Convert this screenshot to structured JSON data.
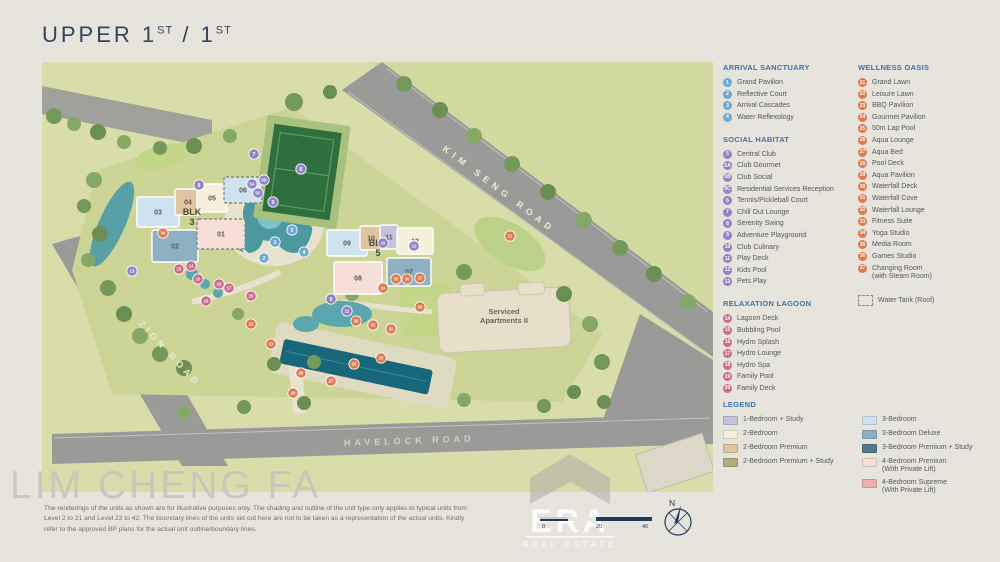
{
  "title": {
    "main": "UPPER 1",
    "sup_a": "ST",
    "divider": " / 1",
    "sup_b": "ST"
  },
  "map": {
    "roads": [
      {
        "name": "KIM SENG ROAD"
      },
      {
        "name": "ZION ROAD"
      },
      {
        "name": "HAVELOCK ROAD"
      }
    ],
    "serviced": {
      "line1": "Serviced",
      "line2": "Apartments II"
    },
    "blocks": [
      {
        "label_top": "BLK",
        "label_num": "3",
        "lx": 150,
        "ly": 153,
        "units": [
          {
            "no": "03",
            "x": 95,
            "y": 135,
            "w": 42,
            "h": 30,
            "type": "3br",
            "dashed": false
          },
          {
            "no": "04",
            "x": 133,
            "y": 127,
            "w": 26,
            "h": 26,
            "type": "2br_premium",
            "dashed": false
          },
          {
            "no": "05",
            "x": 155,
            "y": 122,
            "w": 30,
            "h": 28,
            "type": "2br",
            "dashed": false
          },
          {
            "no": "06",
            "x": 182,
            "y": 115,
            "w": 38,
            "h": 26,
            "type": "3br",
            "dashed": true
          },
          {
            "no": "02",
            "x": 110,
            "y": 168,
            "w": 46,
            "h": 32,
            "type": "3br_deluxe",
            "dashed": false
          },
          {
            "no": "01",
            "x": 155,
            "y": 157,
            "w": 48,
            "h": 30,
            "type": "4br_premium",
            "dashed": true
          }
        ]
      },
      {
        "label_top": "BLK",
        "label_num": "5",
        "lx": 336,
        "ly": 184,
        "units": [
          {
            "no": "09",
            "x": 285,
            "y": 168,
            "w": 40,
            "h": 26,
            "type": "3br",
            "dashed": false
          },
          {
            "no": "10",
            "x": 318,
            "y": 164,
            "w": 22,
            "h": 24,
            "type": "2br_premium",
            "dashed": false
          },
          {
            "no": "11",
            "x": 338,
            "y": 163,
            "w": 18,
            "h": 24,
            "type": "1br_study",
            "dashed": false
          },
          {
            "no": "12",
            "x": 355,
            "y": 166,
            "w": 36,
            "h": 26,
            "type": "2br",
            "dashed": false
          },
          {
            "no": "07",
            "x": 345,
            "y": 196,
            "w": 44,
            "h": 28,
            "type": "3br_deluxe",
            "dashed": false
          },
          {
            "no": "08",
            "x": 292,
            "y": 200,
            "w": 48,
            "h": 32,
            "type": "4br_premium",
            "dashed": false
          }
        ]
      }
    ],
    "markers": [
      {
        "n": "1",
        "cat": "arrival",
        "x": 233,
        "y": 180
      },
      {
        "n": "2",
        "cat": "arrival",
        "x": 222,
        "y": 196
      },
      {
        "n": "3",
        "cat": "arrival",
        "x": 250,
        "y": 168
      },
      {
        "n": "4",
        "cat": "arrival",
        "x": 262,
        "y": 190
      },
      {
        "n": "5",
        "cat": "social",
        "x": 231,
        "y": 140
      },
      {
        "n": "5A",
        "cat": "social",
        "x": 210,
        "y": 122
      },
      {
        "n": "5B",
        "cat": "social",
        "x": 222,
        "y": 118
      },
      {
        "n": "5C",
        "cat": "social",
        "x": 216,
        "y": 131
      },
      {
        "n": "6",
        "cat": "social",
        "x": 259,
        "y": 107
      },
      {
        "n": "7",
        "cat": "social",
        "x": 212,
        "y": 92
      },
      {
        "n": "8",
        "cat": "social",
        "x": 157,
        "y": 123
      },
      {
        "n": "9",
        "cat": "social",
        "x": 289,
        "y": 237
      },
      {
        "n": "10",
        "cat": "social",
        "x": 341,
        "y": 181
      },
      {
        "n": "11",
        "cat": "social",
        "x": 305,
        "y": 249
      },
      {
        "n": "12",
        "cat": "social",
        "x": 372,
        "y": 184
      },
      {
        "n": "13",
        "cat": "social",
        "x": 90,
        "y": 209
      },
      {
        "n": "14",
        "cat": "relaxation",
        "x": 149,
        "y": 204
      },
      {
        "n": "15",
        "cat": "relaxation",
        "x": 137,
        "y": 207
      },
      {
        "n": "16",
        "cat": "relaxation",
        "x": 156,
        "y": 217
      },
      {
        "n": "17",
        "cat": "relaxation",
        "x": 187,
        "y": 226
      },
      {
        "n": "18",
        "cat": "relaxation",
        "x": 177,
        "y": 222
      },
      {
        "n": "19",
        "cat": "relaxation",
        "x": 164,
        "y": 239
      },
      {
        "n": "20",
        "cat": "relaxation",
        "x": 209,
        "y": 234
      },
      {
        "n": "21",
        "cat": "wellness",
        "x": 468,
        "y": 174
      },
      {
        "n": "22",
        "cat": "wellness",
        "x": 209,
        "y": 262
      },
      {
        "n": "23",
        "cat": "wellness",
        "x": 229,
        "y": 282
      },
      {
        "n": "24",
        "cat": "wellness",
        "x": 341,
        "y": 226
      },
      {
        "n": "25",
        "cat": "wellness",
        "x": 312,
        "y": 302
      },
      {
        "n": "26",
        "cat": "wellness",
        "x": 259,
        "y": 311
      },
      {
        "n": "27",
        "cat": "wellness",
        "x": 289,
        "y": 319
      },
      {
        "n": "28",
        "cat": "wellness",
        "x": 339,
        "y": 296
      },
      {
        "n": "29",
        "cat": "wellness",
        "x": 251,
        "y": 331
      },
      {
        "n": "30",
        "cat": "wellness",
        "x": 314,
        "y": 259
      },
      {
        "n": "31",
        "cat": "wellness",
        "x": 331,
        "y": 263
      },
      {
        "n": "32",
        "cat": "wellness",
        "x": 349,
        "y": 267
      },
      {
        "n": "33",
        "cat": "wellness",
        "x": 378,
        "y": 245
      },
      {
        "n": "34",
        "cat": "wellness",
        "x": 121,
        "y": 171
      },
      {
        "n": "35",
        "cat": "wellness",
        "x": 354,
        "y": 217
      },
      {
        "n": "36",
        "cat": "wellness",
        "x": 365,
        "y": 217
      },
      {
        "n": "37",
        "cat": "wellness",
        "x": 378,
        "y": 216
      }
    ]
  },
  "panel": {
    "sections": [
      {
        "id": "arrival",
        "title": "ARRIVAL SANCTUARY",
        "items": [
          {
            "n": "1",
            "label": "Grand Pavilion"
          },
          {
            "n": "2",
            "label": "Reflective Court"
          },
          {
            "n": "3",
            "label": "Arrival Cascades"
          },
          {
            "n": "4",
            "label": "Water Reflexology"
          }
        ]
      },
      {
        "id": "social",
        "title": "SOCIAL HABITAT",
        "items": [
          {
            "n": "5",
            "label": "Central Club"
          },
          {
            "n": "5A",
            "label": "Club Gourmet"
          },
          {
            "n": "5B",
            "label": "Club Social"
          },
          {
            "n": "5C",
            "label": "Residential Services Reception"
          },
          {
            "n": "6",
            "label": "Tennis/Pickleball Court"
          },
          {
            "n": "7",
            "label": "Chill Out Lounge"
          },
          {
            "n": "8",
            "label": "Serenity Swing"
          },
          {
            "n": "9",
            "label": "Adventure Playground"
          },
          {
            "n": "10",
            "label": "Club Culinary"
          },
          {
            "n": "11",
            "label": "Play Deck"
          },
          {
            "n": "12",
            "label": "Kids Pool"
          },
          {
            "n": "13",
            "label": "Pets Play"
          }
        ]
      },
      {
        "id": "relaxation",
        "title": "RELAXATION LAGOON",
        "items": [
          {
            "n": "14",
            "label": "Lagoon Deck"
          },
          {
            "n": "15",
            "label": "Bubbling Pool"
          },
          {
            "n": "16",
            "label": "Hydro Splash"
          },
          {
            "n": "17",
            "label": "Hydro Lounge"
          },
          {
            "n": "18",
            "label": "Hydro Spa"
          },
          {
            "n": "19",
            "label": "Family Pool"
          },
          {
            "n": "20",
            "label": "Family Deck"
          }
        ]
      },
      {
        "id": "wellness",
        "title": "WELLNESS OASIS",
        "items": [
          {
            "n": "21",
            "label": "Grand Lawn"
          },
          {
            "n": "22",
            "label": "Leisure Lawn"
          },
          {
            "n": "23",
            "label": "BBQ Pavilion"
          },
          {
            "n": "24",
            "label": "Gourmet Pavilion"
          },
          {
            "n": "25",
            "label": "50m Lap Pool"
          },
          {
            "n": "26",
            "label": "Aqua Lounge"
          },
          {
            "n": "27",
            "label": "Aqua Bed"
          },
          {
            "n": "28",
            "label": "Pool Deck"
          },
          {
            "n": "29",
            "label": "Aqua Pavilion"
          },
          {
            "n": "30",
            "label": "Waterfall Deck"
          },
          {
            "n": "31",
            "label": "Waterfall Cove"
          },
          {
            "n": "32",
            "label": "Waterfall Lounge"
          },
          {
            "n": "33",
            "label": "Fitness Suite"
          },
          {
            "n": "34",
            "label": "Yoga Studio"
          },
          {
            "n": "35",
            "label": "Media Room"
          },
          {
            "n": "36",
            "label": "Games Studio"
          },
          {
            "n": "37",
            "label": "Changing Room",
            "label2": "(with Steam Room)"
          }
        ]
      }
    ],
    "water_tank_label": "Water Tank (Roof)",
    "legend": {
      "title": "LEGEND",
      "col1": [
        {
          "type": "1br_study",
          "label": "1-Bedroom + Study"
        },
        {
          "type": "2br",
          "label": "2-Bedroom"
        },
        {
          "type": "2br_premium",
          "label": "2-Bedroom Premium"
        },
        {
          "type": "2br_premium_study",
          "label": "2-Bedroom Premium + Study"
        }
      ],
      "col2": [
        {
          "type": "3br",
          "label": "3-Bedroom"
        },
        {
          "type": "3br_deluxe",
          "label": "3-Bedroom Deluxe"
        },
        {
          "type": "3br_premium_study",
          "label": "3-Bedroom Premium + Study"
        },
        {
          "type": "4br_premium",
          "label": "4-Bedroom Premium",
          "label2": "(With Private Lift)"
        },
        {
          "type": "4br_supreme",
          "label": "4-Bedroom Supreme",
          "label2": "(With Private Lift)"
        }
      ]
    }
  },
  "colors": {
    "categories": {
      "arrival": "#6fa9d2",
      "social": "#9184c5",
      "relaxation": "#cb6c8b",
      "wellness": "#dd7a50"
    },
    "unit_types": {
      "1br_study": "#c6c2db",
      "2br": "#f5efdc",
      "2br_premium": "#dfc6a0",
      "2br_premium_study": "#b0ad7f",
      "3br": "#cfe2f0",
      "3br_deluxe": "#8fb0c3",
      "3br_premium_study": "#55798a",
      "4br_premium": "#f6ded9",
      "4br_supreme": "#e9b3aa"
    },
    "accent": "#3f72a8",
    "ink": "#32455f"
  },
  "footer": {
    "disclaimer": "The renderings of the units as shown are for illustrative purposes only. The shading and outline of the unit type only applies to typical units from Level 2 to 21 and Level 23 to 42. The boundary lines of the units set out here are not to be taken as a representation of the actual units. Kindly refer to the approved BP plans for the actual unit outline/boundary lines.",
    "scale_labels": [
      "0",
      "20",
      "40"
    ],
    "compass_n": "N"
  },
  "watermarks": {
    "agent": "LIM CHENG FA",
    "brand_main": "ERA",
    "brand_sub": "REAL ESTATE"
  }
}
